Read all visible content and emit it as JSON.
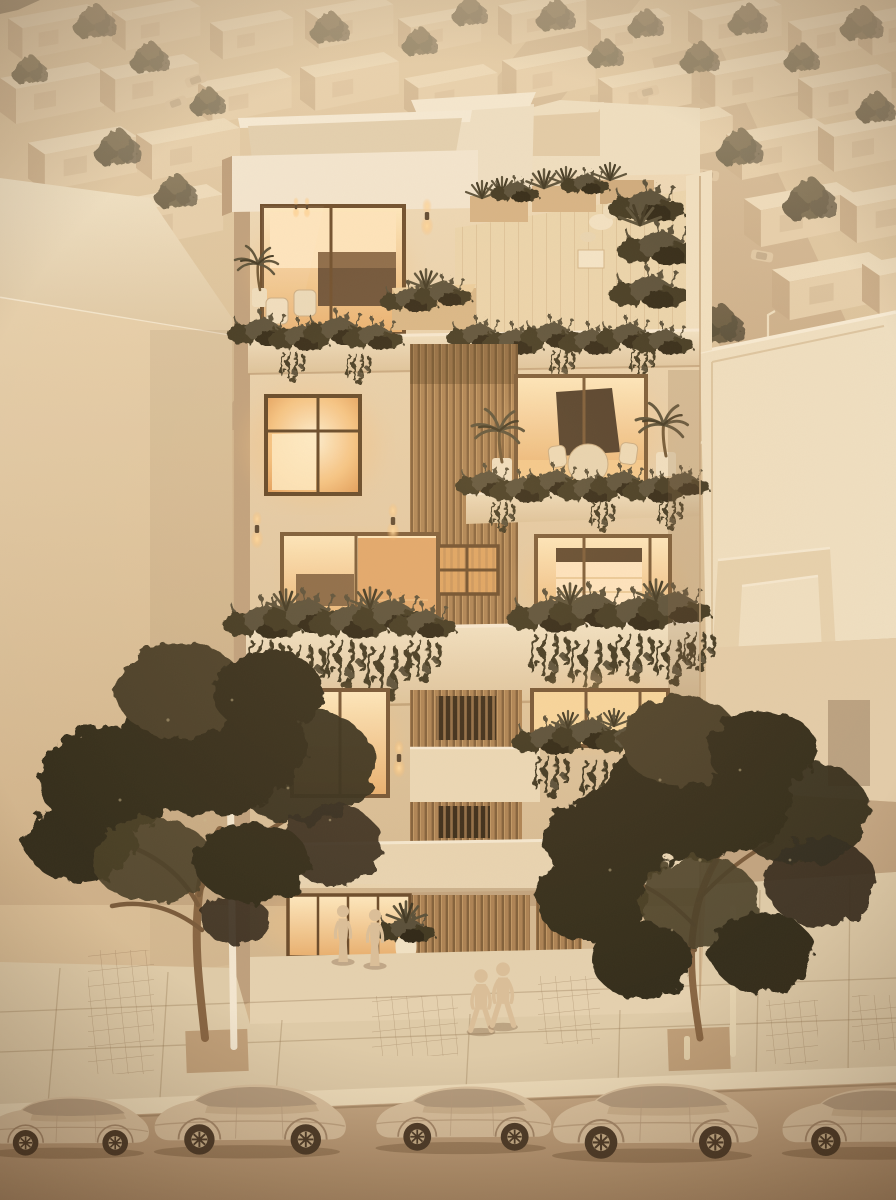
{
  "meta": {
    "type": "architectural-render",
    "description": "Warm dusk 3D clay-model render of a five-storey residential infill building with glowing interiors, vertical wood-slat screens, planted balconies and rooftop terraces, set in a monochrome beige low-rise neighborhood; two dark street trees, four pedestrians and five parked clay cars in the foreground.",
    "time_of_day": "dusk",
    "style": "monochrome beige model with warm interior lighting"
  },
  "palette": {
    "bg_top": "#e2cfae",
    "bg_warm": "#d7bd98",
    "wall_light": "#f3e9d4",
    "wall_mid": "#e4d0af",
    "wall_shadow": "#c0a381",
    "roof_light": "#f0e3c8",
    "window_glow": "#f6c687",
    "glow_bright": "#fff3d6",
    "glow_deep": "#dd9a55",
    "wood": "#ad8457",
    "wood_dark": "#7c5b37",
    "plant_dark": "#3f3723",
    "plant_mid": "#59503a",
    "plant_light": "#6f6849",
    "tree_dark": "#362e1f",
    "tree_mid": "#4b4129",
    "branch": "#8a6845",
    "street": "#c4a987",
    "sidewalk": "#e0cfae",
    "curb": "#efe0c0",
    "car_body": "#dcc5a4",
    "car_shadow": "#a88c6e",
    "glass_tint": "#b7a083",
    "figure": "#dcc29e",
    "frame_dark": "#6b4c2c",
    "sconce_glow": "#ffdfa8"
  },
  "scene": {
    "background_neighborhood": {
      "label": "aerial grid of flat-roofed beige houses with streets, trees and tiny cars",
      "houses": [
        {
          "x": 8,
          "y": 4,
          "s": 0.9
        },
        {
          "x": 112,
          "y": -2,
          "s": 0.85
        },
        {
          "x": 210,
          "y": 10,
          "s": 0.8
        },
        {
          "x": 305,
          "y": -4,
          "s": 0.85
        },
        {
          "x": 398,
          "y": 6,
          "s": 0.8
        },
        {
          "x": 498,
          "y": -8,
          "s": 0.85
        },
        {
          "x": 588,
          "y": 8,
          "s": 0.8
        },
        {
          "x": 688,
          "y": -4,
          "s": 0.9
        },
        {
          "x": 788,
          "y": 8,
          "s": 0.85
        },
        {
          "x": 858,
          "y": 0,
          "s": 0.9
        },
        {
          "x": 0,
          "y": 62,
          "s": 1
        },
        {
          "x": 100,
          "y": 54,
          "s": 0.95
        },
        {
          "x": 198,
          "y": 68,
          "s": 0.9
        },
        {
          "x": 300,
          "y": 52,
          "s": 0.95
        },
        {
          "x": 404,
          "y": 64,
          "s": 0.9
        },
        {
          "x": 502,
          "y": 46,
          "s": 0.9
        },
        {
          "x": 598,
          "y": 64,
          "s": 0.9
        },
        {
          "x": 700,
          "y": 50,
          "s": 0.95
        },
        {
          "x": 798,
          "y": 64,
          "s": 0.9
        },
        {
          "x": 28,
          "y": 126,
          "s": 1.05
        },
        {
          "x": 136,
          "y": 118,
          "s": 1
        },
        {
          "x": 540,
          "y": 116,
          "s": 0.95
        },
        {
          "x": 634,
          "y": 106,
          "s": 0.95
        },
        {
          "x": 726,
          "y": 118,
          "s": 1
        },
        {
          "x": 818,
          "y": 110,
          "s": 1
        },
        {
          "x": 8,
          "y": 192,
          "s": 1.1
        },
        {
          "x": 114,
          "y": 184,
          "s": 1.05
        },
        {
          "x": 744,
          "y": 182,
          "s": 1.05
        },
        {
          "x": 840,
          "y": 178,
          "s": 1.05
        },
        {
          "x": 772,
          "y": 252,
          "s": 1.1
        },
        {
          "x": 862,
          "y": 246,
          "s": 1.1
        },
        {
          "x": 828,
          "y": 330,
          "s": 1.1
        }
      ],
      "trees": [
        {
          "x": 95,
          "y": 22,
          "s": 1.2
        },
        {
          "x": 30,
          "y": 70,
          "s": 1
        },
        {
          "x": 150,
          "y": 58,
          "s": 1.1
        },
        {
          "x": 208,
          "y": 102,
          "s": 1
        },
        {
          "x": 330,
          "y": 28,
          "s": 1.1
        },
        {
          "x": 420,
          "y": 42,
          "s": 1
        },
        {
          "x": 470,
          "y": 12,
          "s": 1
        },
        {
          "x": 556,
          "y": 16,
          "s": 1.1
        },
        {
          "x": 606,
          "y": 54,
          "s": 1
        },
        {
          "x": 646,
          "y": 24,
          "s": 1
        },
        {
          "x": 700,
          "y": 58,
          "s": 1.1
        },
        {
          "x": 748,
          "y": 20,
          "s": 1.1
        },
        {
          "x": 802,
          "y": 58,
          "s": 1
        },
        {
          "x": 862,
          "y": 24,
          "s": 1.2
        },
        {
          "x": 876,
          "y": 108,
          "s": 1.1
        },
        {
          "x": 118,
          "y": 148,
          "s": 1.3
        },
        {
          "x": 58,
          "y": 222,
          "s": 1.3
        },
        {
          "x": 176,
          "y": 192,
          "s": 1.2
        },
        {
          "x": 740,
          "y": 148,
          "s": 1.3
        },
        {
          "x": 810,
          "y": 200,
          "s": 1.5
        },
        {
          "x": 720,
          "y": 325,
          "s": 1.4
        },
        {
          "x": 875,
          "y": 340,
          "s": 1.4
        }
      ],
      "cars": [
        {
          "x": 176,
          "y": 103,
          "r": -20
        },
        {
          "x": 196,
          "y": 80,
          "r": -20
        },
        {
          "x": 648,
          "y": 92,
          "r": -14
        },
        {
          "x": 641,
          "y": 148,
          "r": -14
        },
        {
          "x": 708,
          "y": 175,
          "r": 8
        },
        {
          "x": 762,
          "y": 256,
          "r": 10
        },
        {
          "x": 800,
          "y": 462,
          "r": 16
        }
      ],
      "lamps": [
        {
          "x": 585,
          "y": 200,
          "h": 52
        },
        {
          "x": 768,
          "y": 315,
          "h": 60
        },
        {
          "x": 697,
          "y": 445,
          "h": 56
        }
      ]
    },
    "main_building": {
      "label": "five-storey residential building with wood-slat core and planted balconies",
      "floors": 5,
      "rooftop_terraces": 2,
      "lit_windows": 9,
      "features": [
        "rooftop lounge with chair and coffee table",
        "terrace dining set",
        "cascading balcony planters",
        "vertical wood-slat screens",
        "glowing warm interiors",
        "recessed lobby with glass storefront"
      ],
      "sconces": [
        {
          "x": 427,
          "y": 216,
          "s": 1
        },
        {
          "x": 257,
          "y": 529,
          "s": 1
        },
        {
          "x": 393,
          "y": 521,
          "s": 1
        },
        {
          "x": 399,
          "y": 758,
          "s": 1
        },
        {
          "x": 296,
          "y": 207,
          "s": 0.55
        },
        {
          "x": 307,
          "y": 207,
          "s": 0.55
        }
      ]
    },
    "adjacent_buildings": {
      "left": "tall blank side wall of neighboring house",
      "right": "flat-roofed house with stepped parapets and recessed niche"
    },
    "street_scene": {
      "sidewalk": "large pavers with narrow tile bands and square tree pits",
      "street_trees": 2,
      "lamp_posts": 2,
      "people": [
        {
          "x": 343,
          "y": 962,
          "s": 1.45,
          "pose": "stand",
          "flip": false
        },
        {
          "x": 375,
          "y": 966,
          "s": 1.45,
          "pose": "stand",
          "flip": true
        },
        {
          "x": 481,
          "y": 1032,
          "s": 1.6,
          "pose": "walk",
          "flip": false
        },
        {
          "x": 503,
          "y": 1027,
          "s": 1.65,
          "pose": "walk",
          "flip": false
        }
      ],
      "parked_cars": [
        {
          "x": -16,
          "y": 1086,
          "s": 0.8
        },
        {
          "x": 150,
          "y": 1072,
          "s": 0.95
        },
        {
          "x": 372,
          "y": 1075,
          "s": 0.87
        },
        {
          "x": 548,
          "y": 1070,
          "s": 1.02
        },
        {
          "x": 778,
          "y": 1076,
          "s": 0.92
        }
      ]
    }
  }
}
